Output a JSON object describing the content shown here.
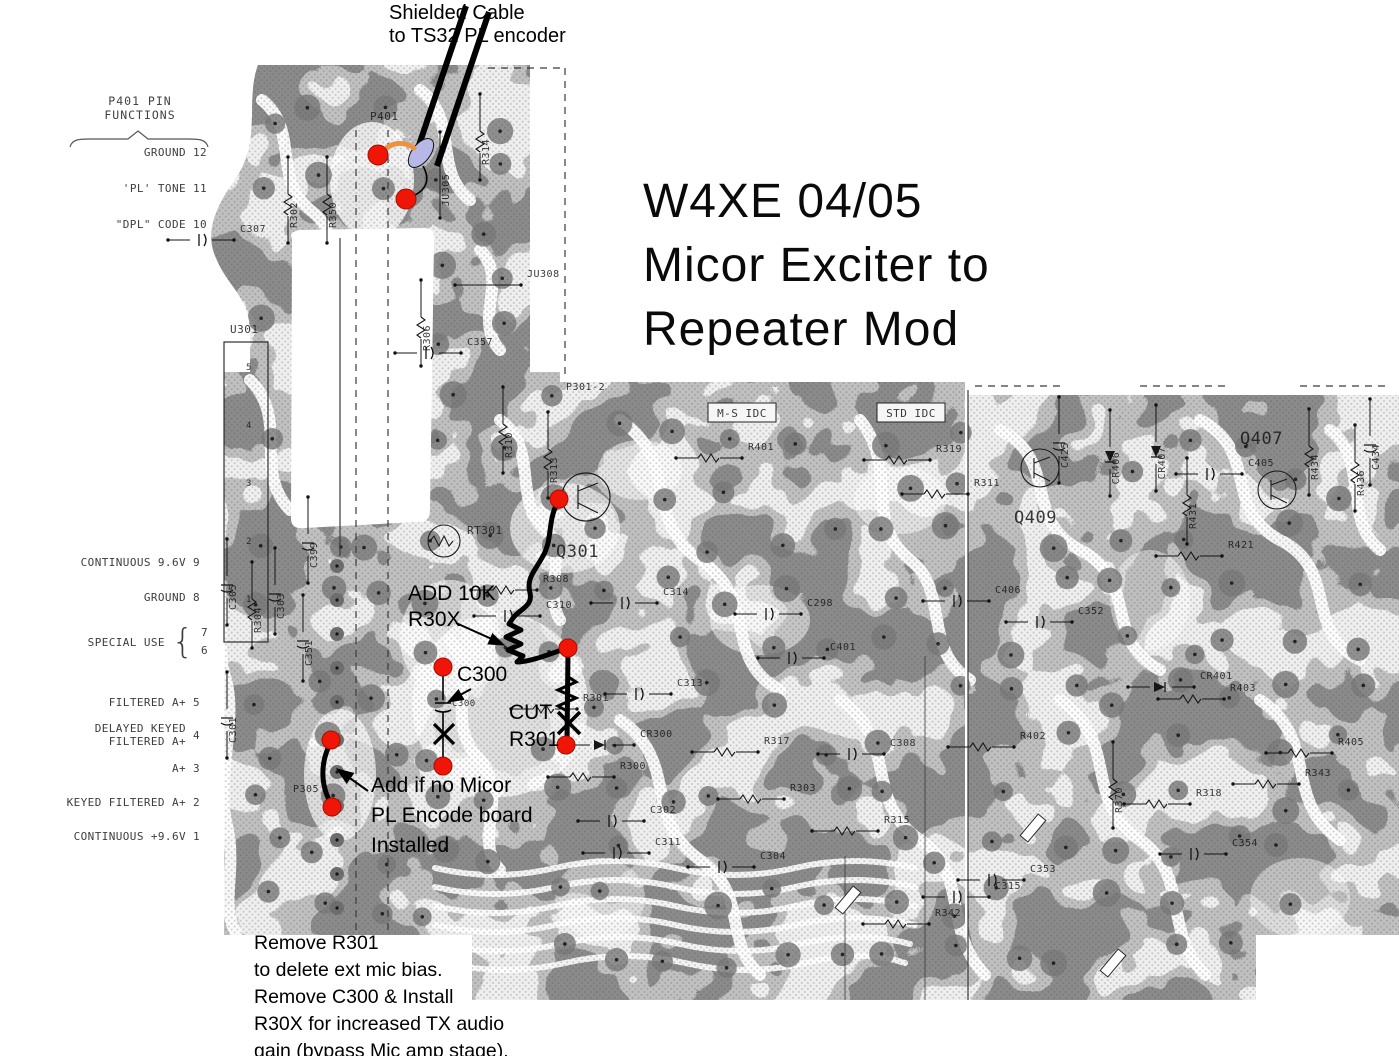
{
  "title": {
    "text": "W4XE 04/05\nMicor Exciter to\nRepeater Mod"
  },
  "annotations": {
    "shielded_cable": "Shielded Cable\nto TS32 PL encoder",
    "add_10k": "ADD 10K\nR30X",
    "c300_callout": "C300",
    "cut_r301": "CUT\nR301",
    "add_jumper": "Add if no Micor\nPL Encode board\nInstalled",
    "bottom_note": "Remove R301\nto delete ext mic bias.\nRemove C300 & Install\nR30X for increased TX audio\ngain (bypass Mic amp stage)."
  },
  "pin_functions": {
    "heading": "P401 PIN\nFUNCTIONS",
    "items": [
      {
        "label": "GROUND",
        "pin": "12"
      },
      {
        "label": "'PL' TONE",
        "pin": "11"
      },
      {
        "label": "\"DPL\" CODE",
        "pin": "10"
      },
      {
        "label": "CONTINUOUS 9.6V",
        "pin": "9"
      },
      {
        "label": "GROUND",
        "pin": "8"
      },
      {
        "label": "SPECIAL USE",
        "pin": "7|6"
      },
      {
        "label": "FILTERED A+",
        "pin": "5"
      },
      {
        "label": "DELAYED KEYED\nFILTERED A+",
        "pin": "4"
      },
      {
        "label": "A+",
        "pin": "3"
      },
      {
        "label": "KEYED FILTERED A+",
        "pin": "2"
      },
      {
        "label": "CONTINUOUS +9.6V",
        "pin": "1"
      }
    ]
  },
  "pcb_labels": [
    {
      "t": "P401",
      "x": 370,
      "y": 120,
      "v": 0,
      "s": 11
    },
    {
      "t": "R314",
      "x": 489,
      "y": 152,
      "v": 1,
      "s": 10
    },
    {
      "t": "JU305",
      "x": 449,
      "y": 190,
      "v": 1,
      "s": 10
    },
    {
      "t": "R350",
      "x": 336,
      "y": 215,
      "v": 1,
      "s": 10
    },
    {
      "t": "R302",
      "x": 297,
      "y": 215,
      "v": 1,
      "s": 10
    },
    {
      "t": "C307",
      "x": 240,
      "y": 232,
      "v": 0,
      "s": 10
    },
    {
      "t": "JU308",
      "x": 527,
      "y": 277,
      "v": 0,
      "s": 10
    },
    {
      "t": "U301",
      "x": 230,
      "y": 333,
      "v": 0,
      "s": 11
    },
    {
      "t": "R306",
      "x": 430,
      "y": 338,
      "v": 1,
      "s": 10
    },
    {
      "t": "C357",
      "x": 467,
      "y": 345,
      "v": 0,
      "s": 10
    },
    {
      "t": "R310",
      "x": 512,
      "y": 445,
      "v": 1,
      "s": 10
    },
    {
      "t": "R313",
      "x": 557,
      "y": 470,
      "v": 1,
      "s": 10
    },
    {
      "t": "P301-2",
      "x": 566,
      "y": 390,
      "v": 0,
      "s": 10
    },
    {
      "t": "M-S IDC",
      "x": 742,
      "y": 417,
      "v": 0,
      "s": 11,
      "b": 1
    },
    {
      "t": "STD IDC",
      "x": 911,
      "y": 417,
      "v": 0,
      "s": 11,
      "b": 1
    },
    {
      "t": "R401",
      "x": 748,
      "y": 450,
      "v": 0,
      "s": 10
    },
    {
      "t": "R319",
      "x": 936,
      "y": 452,
      "v": 0,
      "s": 10
    },
    {
      "t": "R311",
      "x": 974,
      "y": 486,
      "v": 0,
      "s": 10
    },
    {
      "t": "RT301",
      "x": 467,
      "y": 534,
      "v": 0,
      "s": 11
    },
    {
      "t": "Q301",
      "x": 556,
      "y": 557,
      "v": 0,
      "s": 17
    },
    {
      "t": "C399",
      "x": 317,
      "y": 555,
      "v": 1,
      "s": 10
    },
    {
      "t": "R308",
      "x": 543,
      "y": 582,
      "v": 0,
      "s": 10
    },
    {
      "t": "C310",
      "x": 546,
      "y": 608,
      "v": 0,
      "s": 10
    },
    {
      "t": "C314",
      "x": 663,
      "y": 595,
      "v": 0,
      "s": 10
    },
    {
      "t": "C305",
      "x": 236,
      "y": 597,
      "v": 1,
      "s": 10
    },
    {
      "t": "R304",
      "x": 261,
      "y": 620,
      "v": 1,
      "s": 10
    },
    {
      "t": "C303",
      "x": 284,
      "y": 606,
      "v": 1,
      "s": 10
    },
    {
      "t": "C351",
      "x": 312,
      "y": 653,
      "v": 1,
      "s": 10
    },
    {
      "t": "C301",
      "x": 236,
      "y": 730,
      "v": 1,
      "s": 10
    },
    {
      "t": "P305",
      "x": 293,
      "y": 792,
      "v": 0,
      "s": 10
    },
    {
      "t": "C298",
      "x": 807,
      "y": 606,
      "v": 0,
      "s": 10
    },
    {
      "t": "C401",
      "x": 830,
      "y": 650,
      "v": 0,
      "s": 10
    },
    {
      "t": "C313",
      "x": 677,
      "y": 686,
      "v": 0,
      "s": 10
    },
    {
      "t": "R301",
      "x": 583,
      "y": 701,
      "v": 0,
      "s": 10
    },
    {
      "t": "CR300",
      "x": 640,
      "y": 737,
      "v": 0,
      "s": 10
    },
    {
      "t": "R317",
      "x": 764,
      "y": 744,
      "v": 0,
      "s": 10
    },
    {
      "t": "C308",
      "x": 890,
      "y": 746,
      "v": 0,
      "s": 10
    },
    {
      "t": "R300",
      "x": 620,
      "y": 769,
      "v": 0,
      "s": 10
    },
    {
      "t": "R303",
      "x": 790,
      "y": 791,
      "v": 0,
      "s": 10
    },
    {
      "t": "C302",
      "x": 650,
      "y": 813,
      "v": 0,
      "s": 10
    },
    {
      "t": "R315",
      "x": 884,
      "y": 823,
      "v": 0,
      "s": 10
    },
    {
      "t": "C311",
      "x": 655,
      "y": 845,
      "v": 0,
      "s": 10
    },
    {
      "t": "C304",
      "x": 760,
      "y": 859,
      "v": 0,
      "s": 10
    },
    {
      "t": "R342",
      "x": 935,
      "y": 916,
      "v": 0,
      "s": 10
    },
    {
      "t": "C315",
      "x": 995,
      "y": 889,
      "v": 0,
      "s": 10
    },
    {
      "t": "Q409",
      "x": 1014,
      "y": 523,
      "v": 0,
      "s": 17
    },
    {
      "t": "Q407",
      "x": 1240,
      "y": 444,
      "v": 0,
      "s": 17
    },
    {
      "t": "C405",
      "x": 1248,
      "y": 466,
      "v": 0,
      "s": 10
    },
    {
      "t": "C406",
      "x": 995,
      "y": 593,
      "v": 0,
      "s": 10
    },
    {
      "t": "C352",
      "x": 1078,
      "y": 614,
      "v": 0,
      "s": 10
    },
    {
      "t": "C425",
      "x": 1068,
      "y": 455,
      "v": 1,
      "s": 10
    },
    {
      "t": "CR406",
      "x": 1119,
      "y": 468,
      "v": 1,
      "s": 10
    },
    {
      "t": "CR407",
      "x": 1165,
      "y": 463,
      "v": 1,
      "s": 10
    },
    {
      "t": "R431",
      "x": 1196,
      "y": 516,
      "v": 1,
      "s": 10
    },
    {
      "t": "R421",
      "x": 1228,
      "y": 548,
      "v": 0,
      "s": 10
    },
    {
      "t": "R434",
      "x": 1318,
      "y": 467,
      "v": 1,
      "s": 10
    },
    {
      "t": "R436",
      "x": 1364,
      "y": 483,
      "v": 1,
      "s": 10
    },
    {
      "t": "C434",
      "x": 1379,
      "y": 457,
      "v": 1,
      "s": 10
    },
    {
      "t": "R403",
      "x": 1230,
      "y": 691,
      "v": 0,
      "s": 10
    },
    {
      "t": "CR401",
      "x": 1200,
      "y": 679,
      "v": 0,
      "s": 10
    },
    {
      "t": "R402",
      "x": 1020,
      "y": 739,
      "v": 0,
      "s": 10
    },
    {
      "t": "R405",
      "x": 1338,
      "y": 745,
      "v": 0,
      "s": 10
    },
    {
      "t": "R343",
      "x": 1305,
      "y": 776,
      "v": 0,
      "s": 10
    },
    {
      "t": "R318",
      "x": 1196,
      "y": 796,
      "v": 0,
      "s": 10
    },
    {
      "t": "C354",
      "x": 1232,
      "y": 846,
      "v": 0,
      "s": 10
    },
    {
      "t": "R370",
      "x": 1122,
      "y": 800,
      "v": 1,
      "s": 10
    },
    {
      "t": "C353",
      "x": 1030,
      "y": 872,
      "v": 0,
      "s": 10
    },
    {
      "t": "C300",
      "x": 452,
      "y": 706,
      "v": 0,
      "s": 9
    },
    {
      "t": "5",
      "x": 246,
      "y": 370,
      "v": 0,
      "s": 9
    },
    {
      "t": "4",
      "x": 246,
      "y": 428,
      "v": 0,
      "s": 9
    },
    {
      "t": "3",
      "x": 246,
      "y": 486,
      "v": 0,
      "s": 9
    },
    {
      "t": "2",
      "x": 246,
      "y": 544,
      "v": 0,
      "s": 9
    },
    {
      "t": "1",
      "x": 246,
      "y": 602,
      "v": 0,
      "s": 9
    }
  ],
  "colors": {
    "red_marker": "#ef1607",
    "jumper_wire": "#000000",
    "pigtail_wire": "#ef9240",
    "shield_sleeve": "#b7b7e8",
    "trace_dark": "#8b8b8b",
    "trace_light": "#c0c0c0",
    "board_base": "#efefef"
  }
}
